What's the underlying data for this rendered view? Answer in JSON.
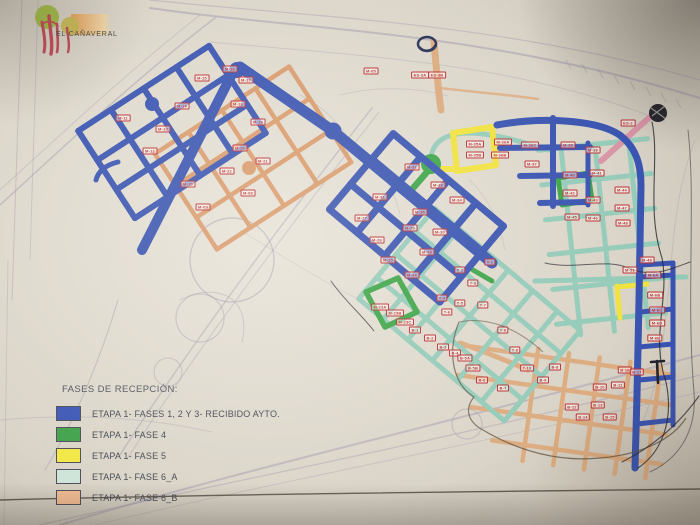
{
  "logo": {
    "title": "EL CAÑAVERAL"
  },
  "legend": {
    "title": "FASES DE RECEPCIÓN:",
    "items": [
      {
        "label": "ETAPA 1- FASES 1, 2 Y 3- RECIBIDO AYTO.",
        "color": "#3a55b4"
      },
      {
        "label": "ETAPA 1- FASE 4",
        "color": "#3ea048"
      },
      {
        "label": "ETAPA 1- FASE 5",
        "color": "#f2e743"
      },
      {
        "label": "ETAPA 1- FASE 6_A",
        "color": "#cfe4d8"
      },
      {
        "label": "ETAPA 1- FASE 6_B",
        "color": "#f4bd92"
      }
    ]
  },
  "colors": {
    "blue": "#3752b0",
    "green": "#3aa345",
    "yellow": "#f0e23c",
    "teal": "#93cab8",
    "salmon": "#dcaa7e",
    "orange": "#d9996a",
    "pink": "#d893a5",
    "label": "#bb2d32",
    "pen": "#23232b"
  },
  "map": {
    "block_labels": [
      {
        "t": "M-16",
        "x": 230,
        "y": 69
      },
      {
        "t": "M-17",
        "x": 246,
        "y": 80
      },
      {
        "t": "M-15",
        "x": 202,
        "y": 78
      },
      {
        "t": "M-14",
        "x": 182,
        "y": 106
      },
      {
        "t": "M-13",
        "x": 163,
        "y": 129
      },
      {
        "t": "M-12",
        "x": 150,
        "y": 151
      },
      {
        "t": "M-11",
        "x": 123,
        "y": 118
      },
      {
        "t": "M-10",
        "x": 188,
        "y": 184
      },
      {
        "t": "M-09",
        "x": 203,
        "y": 207
      },
      {
        "t": "M-18",
        "x": 238,
        "y": 104
      },
      {
        "t": "M-19",
        "x": 258,
        "y": 122
      },
      {
        "t": "M-20",
        "x": 240,
        "y": 148
      },
      {
        "t": "M-21",
        "x": 263,
        "y": 161
      },
      {
        "t": "M-22",
        "x": 227,
        "y": 171
      },
      {
        "t": "M-08",
        "x": 248,
        "y": 193
      },
      {
        "t": "M-05",
        "x": 371,
        "y": 71
      },
      {
        "t": "ES-3A",
        "x": 420,
        "y": 75
      },
      {
        "t": "ES-3B",
        "x": 437,
        "y": 75
      },
      {
        "t": "ES-2",
        "x": 628,
        "y": 123
      },
      {
        "t": "M-32",
        "x": 412,
        "y": 167
      },
      {
        "t": "M-33",
        "x": 438,
        "y": 185
      },
      {
        "t": "M-31",
        "x": 380,
        "y": 197
      },
      {
        "t": "M-34",
        "x": 457,
        "y": 200
      },
      {
        "t": "M-35",
        "x": 420,
        "y": 212
      },
      {
        "t": "M-27",
        "x": 362,
        "y": 218
      },
      {
        "t": "M-29",
        "x": 410,
        "y": 228
      },
      {
        "t": "M-26",
        "x": 377,
        "y": 240
      },
      {
        "t": "M-30",
        "x": 440,
        "y": 232
      },
      {
        "t": "M-28",
        "x": 427,
        "y": 252
      },
      {
        "t": "M-25",
        "x": 388,
        "y": 260
      },
      {
        "t": "M-35A",
        "x": 475,
        "y": 144
      },
      {
        "t": "M-35B",
        "x": 475,
        "y": 155
      },
      {
        "t": "M-36A",
        "x": 503,
        "y": 142
      },
      {
        "t": "M-36B",
        "x": 500,
        "y": 155
      },
      {
        "t": "M-36C",
        "x": 530,
        "y": 145
      },
      {
        "t": "M-37",
        "x": 532,
        "y": 164
      },
      {
        "t": "M-38",
        "x": 568,
        "y": 145
      },
      {
        "t": "M-39",
        "x": 593,
        "y": 150
      },
      {
        "t": "M-40",
        "x": 570,
        "y": 175
      },
      {
        "t": "M-41",
        "x": 597,
        "y": 173
      },
      {
        "t": "M-42",
        "x": 570,
        "y": 193
      },
      {
        "t": "M-43",
        "x": 593,
        "y": 200
      },
      {
        "t": "M-44",
        "x": 622,
        "y": 190
      },
      {
        "t": "M-45",
        "x": 572,
        "y": 217
      },
      {
        "t": "M-46",
        "x": 593,
        "y": 218
      },
      {
        "t": "M-47",
        "x": 622,
        "y": 208
      },
      {
        "t": "M-48",
        "x": 623,
        "y": 223
      },
      {
        "t": "M-49",
        "x": 647,
        "y": 260
      },
      {
        "t": "M-51",
        "x": 630,
        "y": 270
      },
      {
        "t": "T-1",
        "x": 490,
        "y": 262
      },
      {
        "t": "T-2",
        "x": 460,
        "y": 270
      },
      {
        "t": "M-24",
        "x": 412,
        "y": 275
      },
      {
        "t": "T-3",
        "x": 473,
        "y": 283
      },
      {
        "t": "T-4",
        "x": 442,
        "y": 298
      },
      {
        "t": "T-5",
        "x": 460,
        "y": 303
      },
      {
        "t": "T-6",
        "x": 447,
        "y": 312
      },
      {
        "t": "M-23A",
        "x": 380,
        "y": 307
      },
      {
        "t": "M-23B",
        "x": 395,
        "y": 313
      },
      {
        "t": "M-23C",
        "x": 405,
        "y": 322
      },
      {
        "t": "B-1",
        "x": 415,
        "y": 330
      },
      {
        "t": "B-2",
        "x": 430,
        "y": 338
      },
      {
        "t": "B-3",
        "x": 443,
        "y": 347
      },
      {
        "t": "B-4",
        "x": 455,
        "y": 353
      },
      {
        "t": "B-5A",
        "x": 465,
        "y": 358
      },
      {
        "t": "B-5B",
        "x": 473,
        "y": 368
      },
      {
        "t": "B-6",
        "x": 482,
        "y": 380
      },
      {
        "t": "B-7",
        "x": 503,
        "y": 388
      },
      {
        "t": "T-7",
        "x": 483,
        "y": 305
      },
      {
        "t": "T-8",
        "x": 503,
        "y": 330
      },
      {
        "t": "T-9",
        "x": 515,
        "y": 350
      },
      {
        "t": "T-10",
        "x": 527,
        "y": 368
      },
      {
        "t": "M-6A",
        "x": 653,
        "y": 275
      },
      {
        "t": "M-6B",
        "x": 655,
        "y": 295
      },
      {
        "t": "M-6C",
        "x": 657,
        "y": 310
      },
      {
        "t": "M-6D",
        "x": 657,
        "y": 323
      },
      {
        "t": "M-6E",
        "x": 655,
        "y": 338
      },
      {
        "t": "B-8",
        "x": 555,
        "y": 367
      },
      {
        "t": "B-9",
        "x": 543,
        "y": 380
      },
      {
        "t": "B-10",
        "x": 600,
        "y": 387
      },
      {
        "t": "B-11",
        "x": 618,
        "y": 385
      },
      {
        "t": "B-12",
        "x": 572,
        "y": 407
      },
      {
        "t": "B-13",
        "x": 598,
        "y": 405
      },
      {
        "t": "B-14",
        "x": 583,
        "y": 417
      },
      {
        "t": "B-15",
        "x": 610,
        "y": 417
      },
      {
        "t": "B-16",
        "x": 625,
        "y": 370
      },
      {
        "t": "B-17",
        "x": 637,
        "y": 372
      }
    ]
  }
}
